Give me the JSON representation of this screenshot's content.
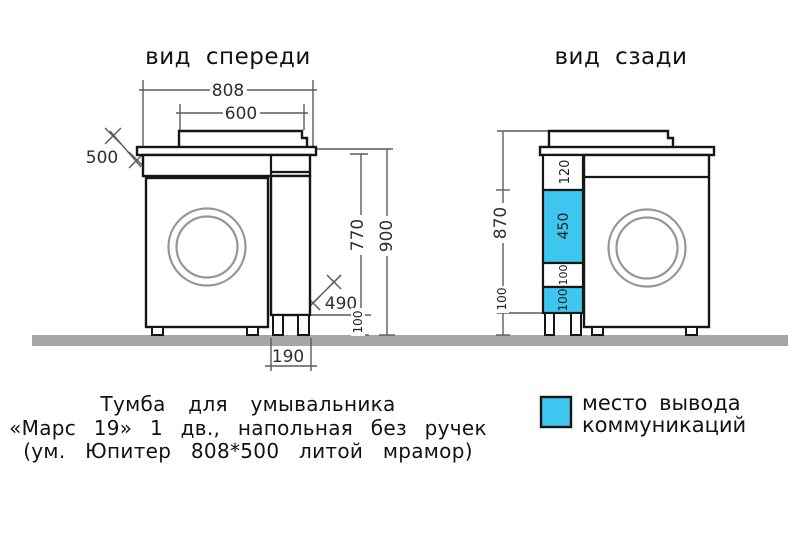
{
  "titles": {
    "front_view": "вид спереди",
    "back_view": "вид сзади"
  },
  "front_view": {
    "dim_total_width": "808",
    "dim_sink_width": "600",
    "dim_depth": "500",
    "dim_body_height": "770",
    "dim_total_height": "900",
    "dim_niche": "490",
    "dim_leg_height": "100",
    "dim_pedestal_width": "190"
  },
  "back_view": {
    "dim_total_height": "870",
    "dim_leg_height": "100",
    "dim_section_top": "120",
    "dim_section_main": "450",
    "dim_section_mid": "100",
    "dim_section_bottom": "100"
  },
  "caption": {
    "line1": "Тумба для умывальника",
    "line2": "«Марс 19» 1 дв., напольная без ручек",
    "line3": "(ум. Юпитер 808*500 литой мрамор)"
  },
  "legend": {
    "label_line1": "место вывода",
    "label_line2": "коммуникаций"
  },
  "colors": {
    "communication_highlight": "#3ec6f0",
    "floor": "#a6a6a6"
  }
}
